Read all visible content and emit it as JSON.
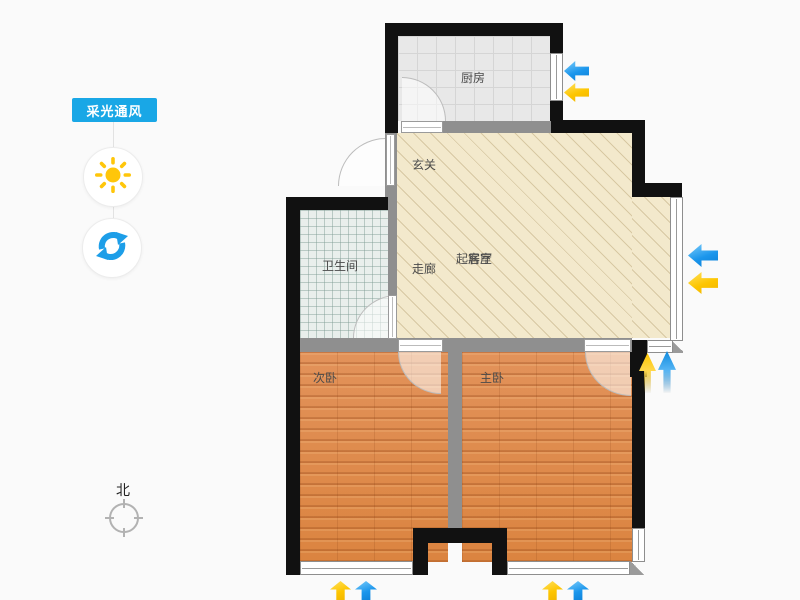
{
  "panel": {
    "badge_label": "采光通风",
    "badge_color": "#19a7e6",
    "tools": [
      {
        "name": "daylight",
        "icon": "sun-icon",
        "color": "#ffc60a"
      },
      {
        "name": "ventilation",
        "icon": "refresh-icon",
        "color": "#1d9ee8"
      }
    ]
  },
  "compass": {
    "label": "北"
  },
  "floorplan": {
    "rooms": {
      "kitchen": "厨房",
      "entry": "玄关",
      "bathroom": "卫生间",
      "corridor": "走廊",
      "living_a": "起居室",
      "living_b": "客厅",
      "bedroom_second": "次卧",
      "bedroom_master": "主卧"
    },
    "colors": {
      "wall": "#111111",
      "wall_light": "#8f8f8f",
      "floor_hall": "#f3e9cc",
      "floor_kitchen": "#e8e8e8",
      "floor_bath": "#e9efec",
      "floor_wood": "#e08c49",
      "arrow_blue": "#1b96ec",
      "arrow_yellow": "#fdc500"
    },
    "arrows": [
      {
        "dir": "left",
        "color": "blue",
        "x": 564,
        "y": 61,
        "w": 25,
        "h": 20,
        "fade": false
      },
      {
        "dir": "left",
        "color": "yellow",
        "x": 564,
        "y": 83,
        "w": 25,
        "h": 19,
        "fade": false
      },
      {
        "dir": "left",
        "color": "blue",
        "x": 688,
        "y": 244,
        "w": 30,
        "h": 23,
        "fade": false
      },
      {
        "dir": "left",
        "color": "yellow",
        "x": 688,
        "y": 272,
        "w": 30,
        "h": 22,
        "fade": false
      },
      {
        "dir": "up",
        "color": "yellow",
        "x": 639,
        "y": 353,
        "w": 17,
        "h": 40,
        "fade": true
      },
      {
        "dir": "up",
        "color": "blue",
        "x": 658,
        "y": 351,
        "w": 18,
        "h": 42,
        "fade": true
      },
      {
        "dir": "up",
        "color": "yellow",
        "x": 330,
        "y": 581,
        "w": 21,
        "h": 19,
        "fade": false
      },
      {
        "dir": "up",
        "color": "blue",
        "x": 355,
        "y": 581,
        "w": 22,
        "h": 19,
        "fade": false
      },
      {
        "dir": "up",
        "color": "yellow",
        "x": 542,
        "y": 581,
        "w": 21,
        "h": 19,
        "fade": false
      },
      {
        "dir": "up",
        "color": "blue",
        "x": 567,
        "y": 581,
        "w": 22,
        "h": 19,
        "fade": false
      }
    ]
  }
}
